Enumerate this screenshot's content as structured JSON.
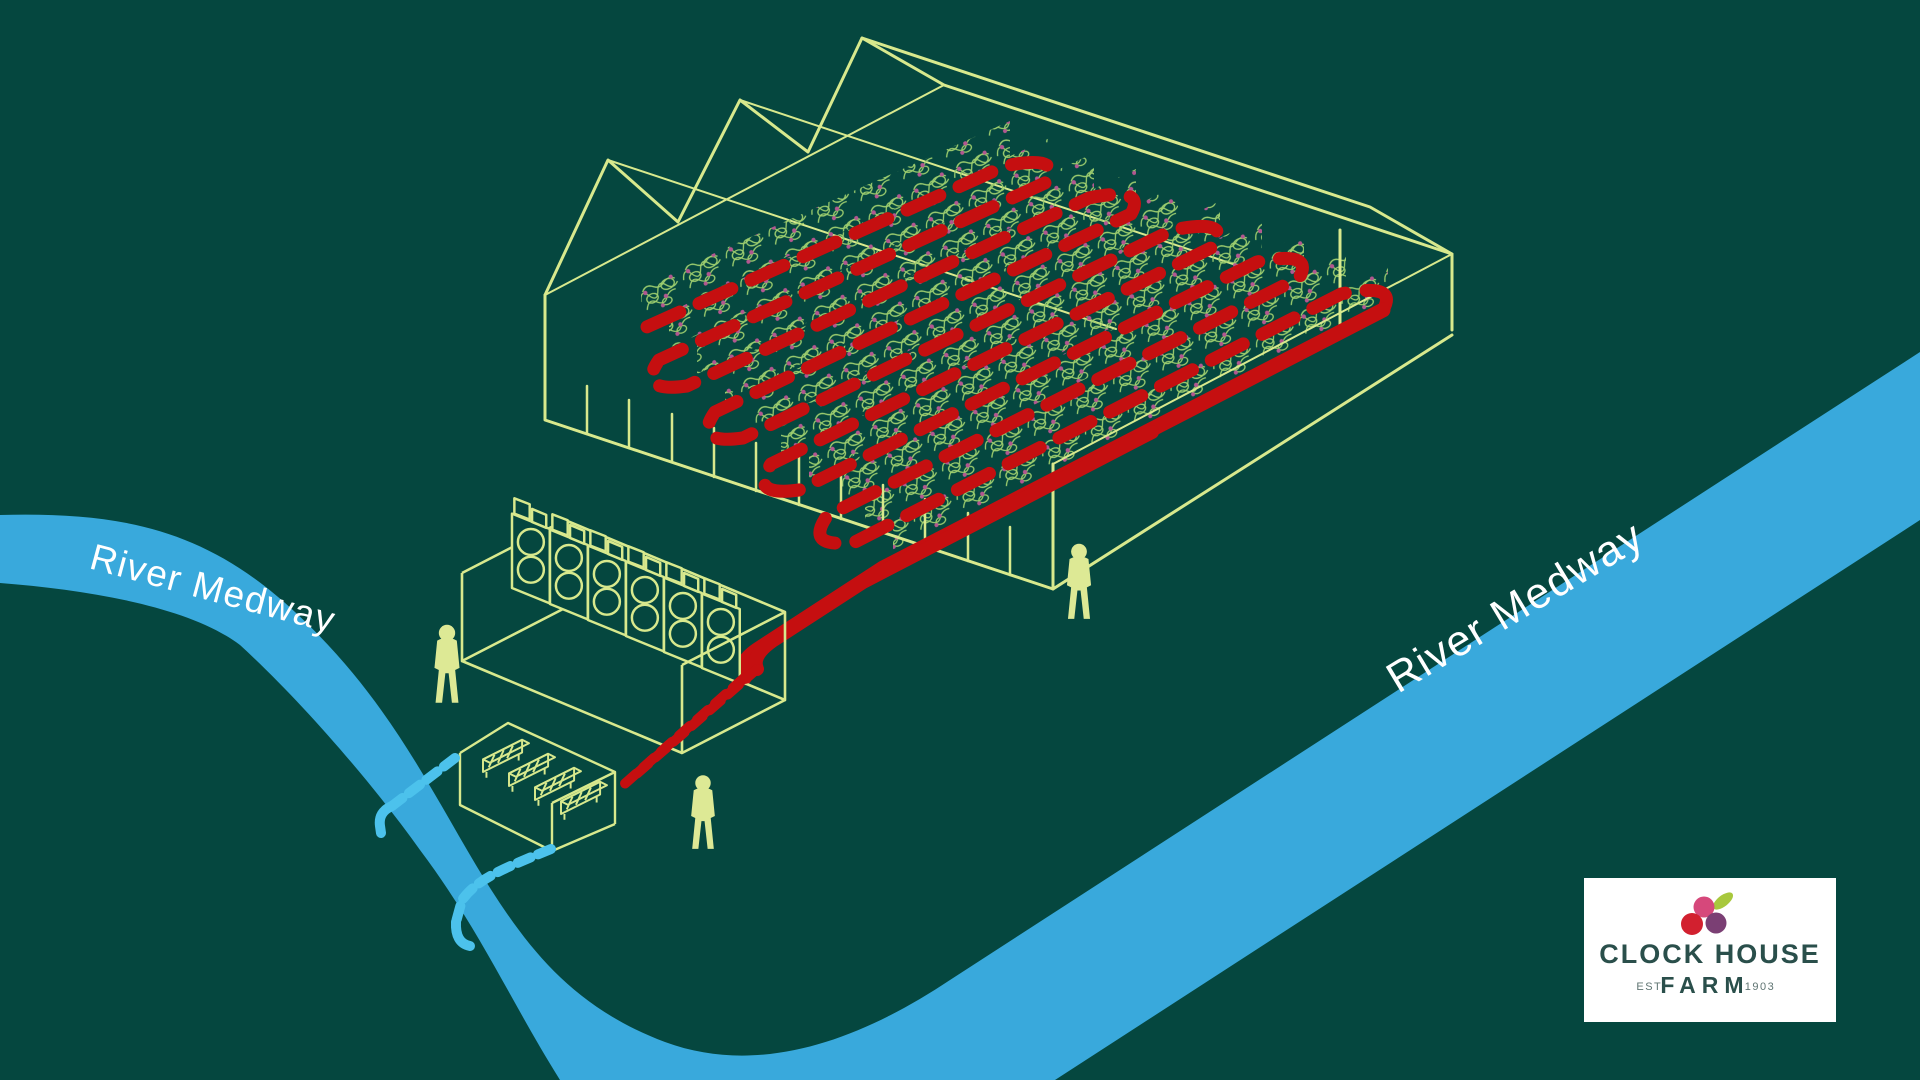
{
  "river": {
    "label_left": "River Medway",
    "label_right": "River Medway"
  },
  "logo": {
    "title": "CLOCK HOUSE",
    "est_label": "EST.",
    "farm_label": "FARM",
    "year": "1903"
  },
  "colors": {
    "background": "#05473f",
    "river": "#39a9dc",
    "river_label": "#ffffff",
    "outline": "#d8e98d",
    "hot_pipe": "#c50f10",
    "cold_pipe": "#4cc2ec",
    "foliage": "#9ccd6e",
    "berry": "#b25790",
    "figure": "#dde995",
    "logo_panel": "#ffffff",
    "logo_text": "#2a4f4b",
    "logo_muted": "#5f7472",
    "logo_pink": "#d6487b",
    "logo_red": "#d2202f",
    "logo_purple": "#7b3f74",
    "logo_leaf": "#a8c83d"
  },
  "scene": {
    "people": 3,
    "heat_pump_units": 6,
    "pump_units": 4,
    "greenhouse_gables": 3
  }
}
